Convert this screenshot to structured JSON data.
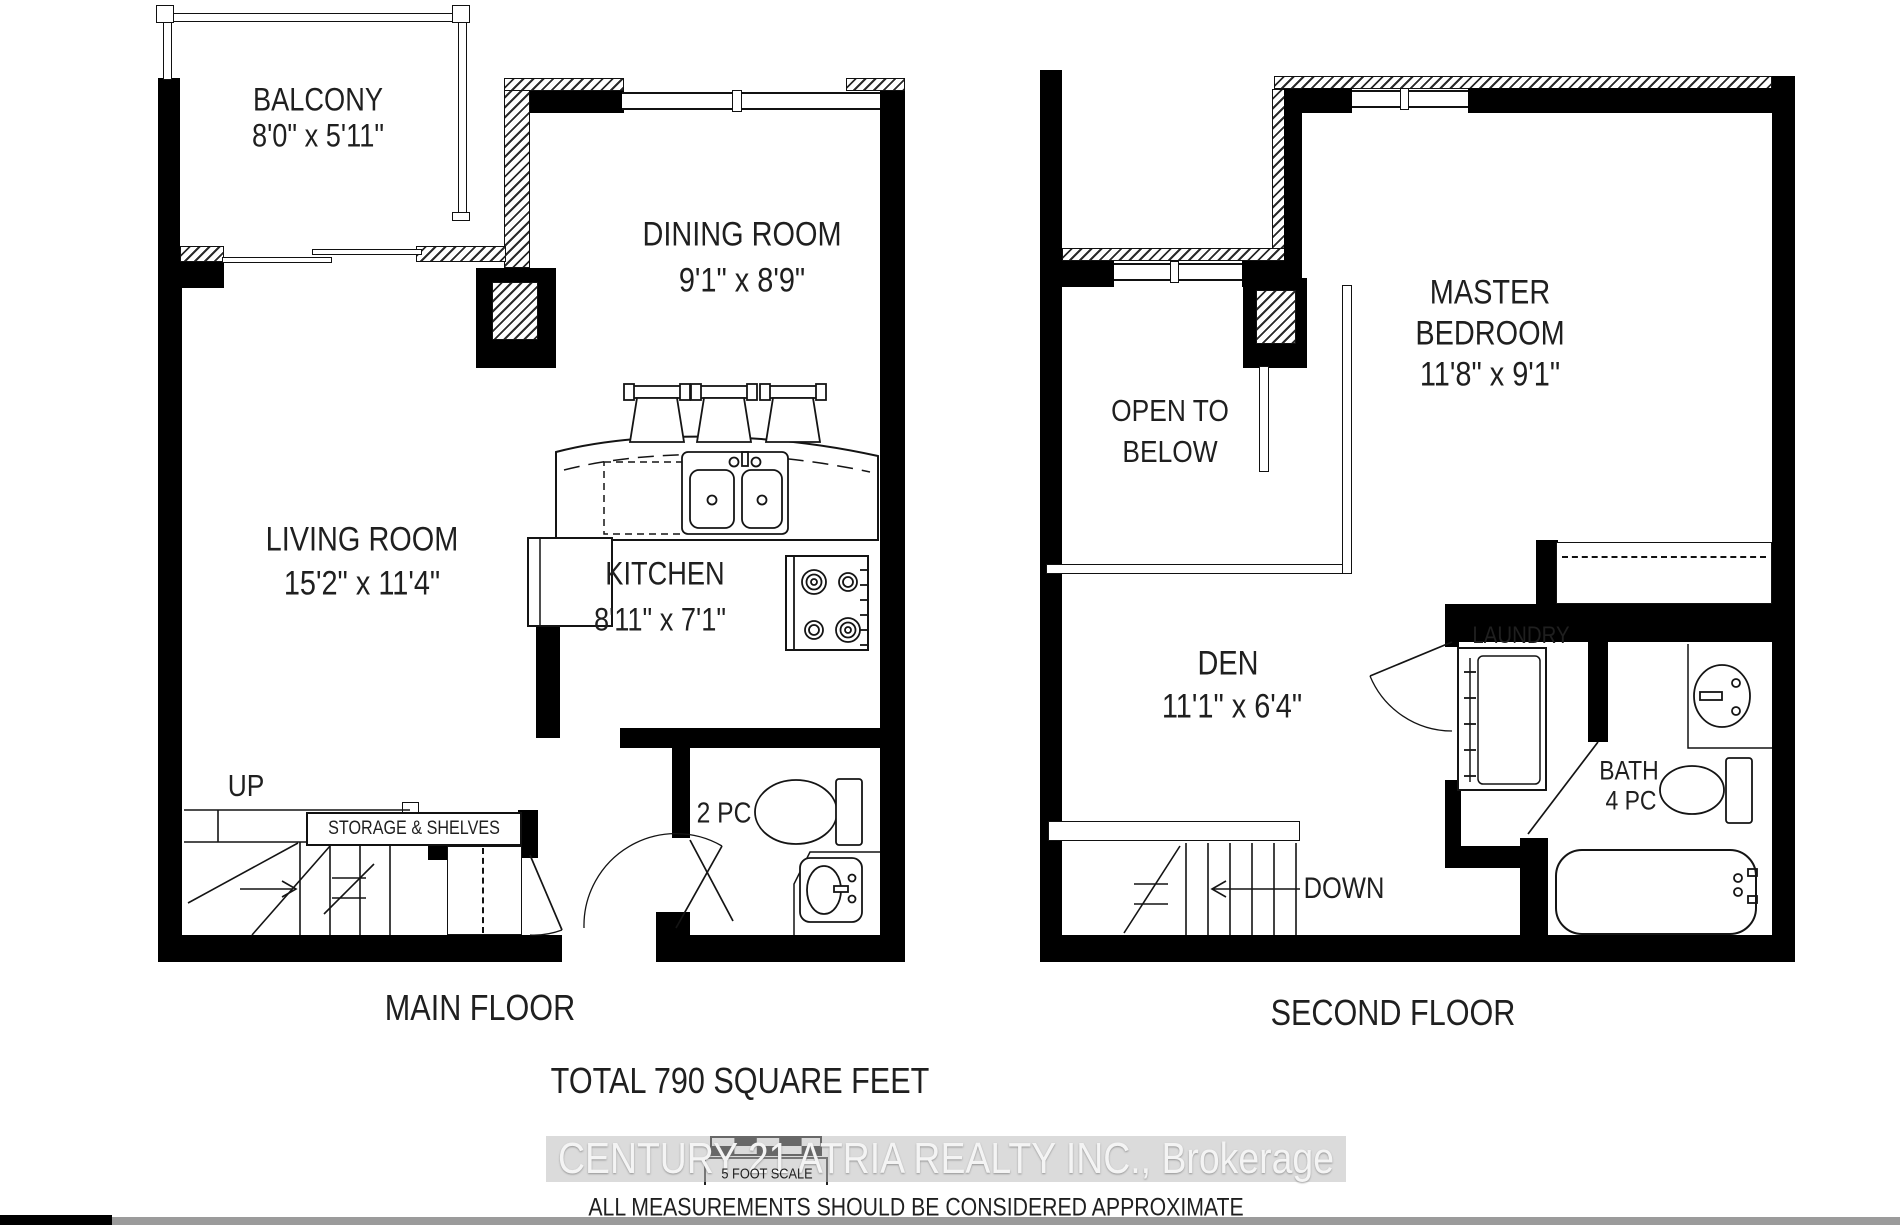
{
  "main_floor": {
    "title": "MAIN FLOOR",
    "balcony": {
      "name": "BALCONY",
      "dims": "8'0\" x 5'11\""
    },
    "dining_room": {
      "name": "DINING ROOM",
      "dims": "9'1\" x 8'9\""
    },
    "living_room": {
      "name": "LIVING ROOM",
      "dims": "15'2\" x 11'4\""
    },
    "kitchen": {
      "name": "KITCHEN",
      "dims": "8'11\" x 7'1\""
    },
    "powder_room": {
      "name": "2 PC"
    },
    "stairs_label": "UP",
    "storage_label": "STORAGE & SHELVES"
  },
  "second_floor": {
    "title": "SECOND FLOOR",
    "master_bedroom": {
      "name_line1": "MASTER",
      "name_line2": "BEDROOM",
      "dims": "11'8\" x 9'1\""
    },
    "open_to_below": {
      "line1": "OPEN TO",
      "line2": "BELOW"
    },
    "den": {
      "name": "DEN",
      "dims": "11'1\" x 6'4\""
    },
    "laundry": {
      "name": "LAUNDRY"
    },
    "bath": {
      "name": "BATH",
      "pieces": "4 PC"
    },
    "stairs_label": "DOWN"
  },
  "footer": {
    "total_area": "TOTAL 790 SQUARE FEET",
    "watermark": "CENTURY 21 ATRIA REALTY INC., Brokerage",
    "scale_label": "5 FOOT SCALE",
    "disclaimer": "ALL MEASUREMENTS SHOULD BE CONSIDERED APPROXIMATE"
  },
  "colors": {
    "wall": "#000000",
    "line": "#141414",
    "background": "#ffffff",
    "watermark_band": "#bdbdbd",
    "watermark_text": "#f4f4f4",
    "bottom_bar_black": "#000000",
    "bottom_bar_gray": "#9b9b9b"
  }
}
